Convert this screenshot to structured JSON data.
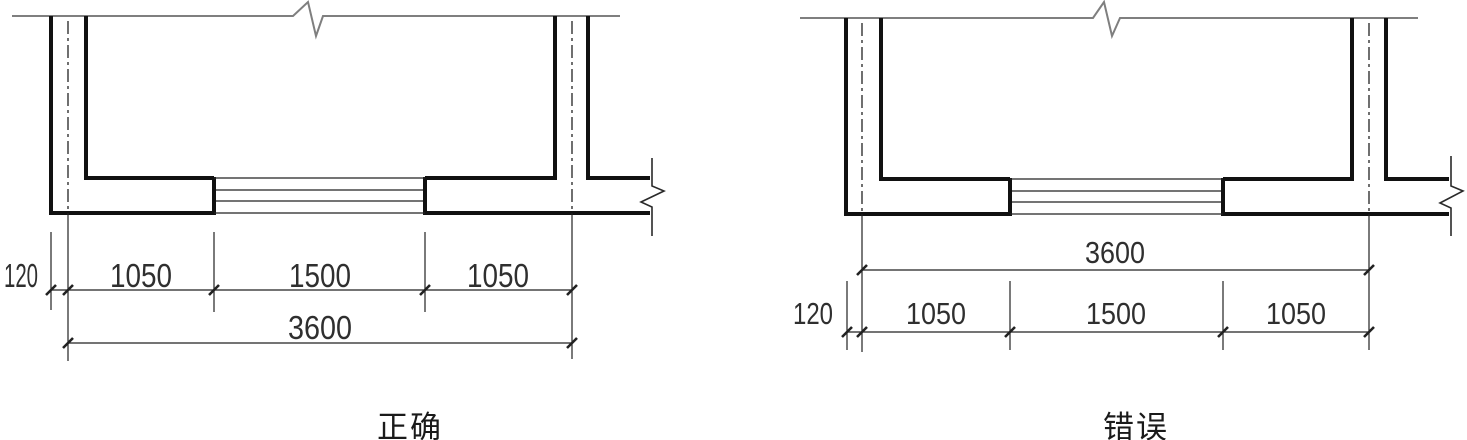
{
  "colors": {
    "wall": "#111111",
    "line": "#222222",
    "break_line": "#2a2a2a",
    "top_wall_line": "#7f7f7f",
    "dim_text": "#2f2f2f",
    "muted_text": "#9e9e9e",
    "caption_text": "#1a1a1a",
    "background": "#ffffff"
  },
  "figures": [
    {
      "caption": "正确",
      "dims": {
        "offset": "120",
        "left": "1050",
        "middle": "1500",
        "right": "1050",
        "overall": "3600"
      }
    },
    {
      "caption": "错误",
      "dims": {
        "offset": "120",
        "left": "1050",
        "middle": "1500",
        "right": "1050",
        "overall": "3600"
      }
    }
  ]
}
